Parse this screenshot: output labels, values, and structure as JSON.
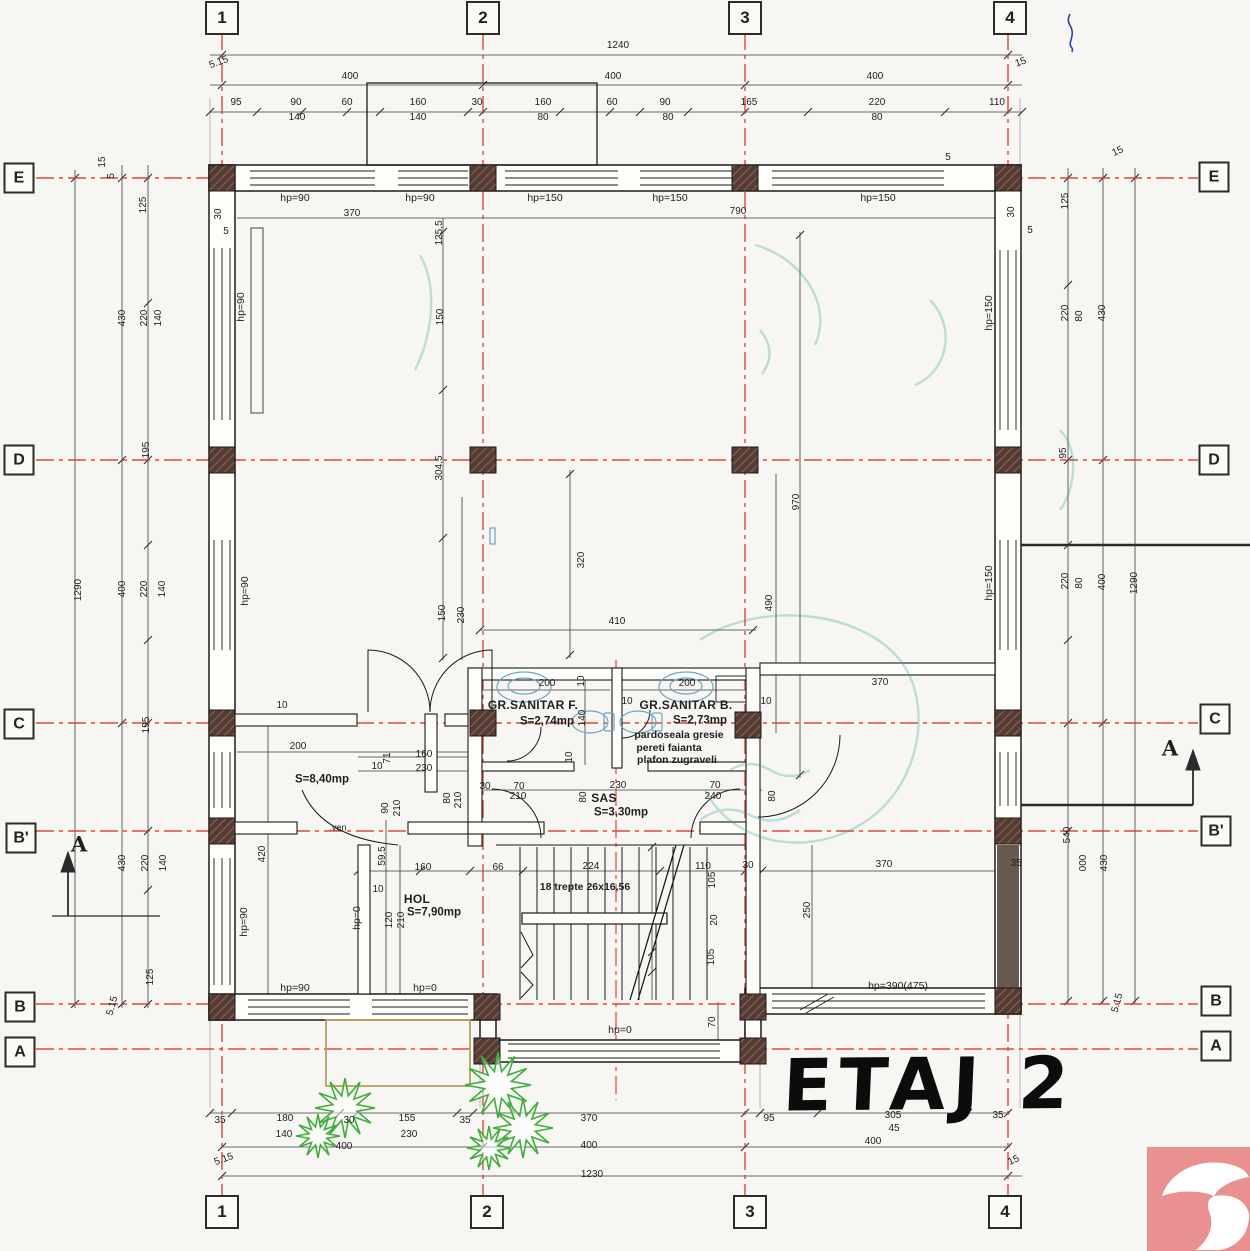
{
  "title": {
    "text": "ETAJ 2"
  },
  "colors": {
    "axis_red": "#d63c2e",
    "wall_ink": "#1b1b1b",
    "column_fill": "#4e3e37",
    "column_hatch": "#a8574a",
    "stamp_teal": "#35a191",
    "plant_green": "#3fae3c",
    "fixture_blue": "#69a7c4",
    "logo_salmon": "#e99090",
    "paper": "#f7f6f2"
  },
  "grid_bubbles": {
    "top": [
      {
        "label": "1",
        "x": 222,
        "y": 18
      },
      {
        "label": "2",
        "x": 483,
        "y": 18
      },
      {
        "label": "3",
        "x": 745,
        "y": 18
      },
      {
        "label": "4",
        "x": 1010,
        "y": 18
      }
    ],
    "bottom": [
      {
        "label": "1",
        "x": 222,
        "y": 1212
      },
      {
        "label": "2",
        "x": 487,
        "y": 1212
      },
      {
        "label": "3",
        "x": 750,
        "y": 1212
      },
      {
        "label": "4",
        "x": 1005,
        "y": 1212
      }
    ],
    "left": [
      {
        "label": "E",
        "x": 19,
        "y": 178
      },
      {
        "label": "D",
        "x": 19,
        "y": 460
      },
      {
        "label": "C",
        "x": 19,
        "y": 724
      },
      {
        "label": "B'",
        "x": 21,
        "y": 838
      },
      {
        "label": "B",
        "x": 20,
        "y": 1007
      },
      {
        "label": "A",
        "x": 20,
        "y": 1052
      }
    ],
    "right": [
      {
        "label": "E",
        "x": 1214,
        "y": 177
      },
      {
        "label": "D",
        "x": 1214,
        "y": 460
      },
      {
        "label": "C",
        "x": 1215,
        "y": 719
      },
      {
        "label": "B'",
        "x": 1216,
        "y": 831
      },
      {
        "label": "B",
        "x": 1216,
        "y": 1001
      },
      {
        "label": "A",
        "x": 1216,
        "y": 1046
      }
    ]
  },
  "rooms": [
    {
      "name": "GR.SANITAR F.",
      "area": "S=2,74mp",
      "nx": 533,
      "ny": 705,
      "ax": 547,
      "ay": 722
    },
    {
      "name": "GR.SANITAR B.",
      "area": "S=2,73mp",
      "nx": 686,
      "ny": 705,
      "ax": 700,
      "ay": 721
    },
    {
      "name": "SAS",
      "area": "S=3,30mp",
      "nx": 604,
      "ny": 798,
      "ax": 621,
      "ay": 813
    },
    {
      "name": "HOL",
      "area": "S=7,90mp",
      "nx": 417,
      "ny": 899,
      "ax": 434,
      "ay": 913
    },
    {
      "name": "",
      "area": "S=8,40mp",
      "nx": 322,
      "ny": 766,
      "ax": 322,
      "ay": 780
    }
  ],
  "finish_notes": [
    {
      "t": "pardoseala gresie",
      "x": 679,
      "y": 735
    },
    {
      "t": "pereti faianta",
      "x": 669,
      "y": 748
    },
    {
      "t": "plafon zugraveli",
      "x": 677,
      "y": 760
    }
  ],
  "stairs_note": {
    "t": "18 trepte 26x16,56",
    "x": 585,
    "y": 887
  },
  "vent_note": {
    "t": ".ven",
    "x": 338,
    "y": 828
  },
  "section_labels": [
    {
      "t": "A",
      "x": 79,
      "y": 844
    },
    {
      "t": "A",
      "x": 1170,
      "y": 748
    }
  ],
  "hp_labels": [
    {
      "t": "hp=90",
      "x": 295,
      "y": 198
    },
    {
      "t": "hp=90",
      "x": 420,
      "y": 198
    },
    {
      "t": "hp=150",
      "x": 545,
      "y": 198
    },
    {
      "t": "hp=150",
      "x": 670,
      "y": 198
    },
    {
      "t": "hp=150",
      "x": 878,
      "y": 198
    },
    {
      "t": "hp=90",
      "x": 241,
      "y": 307,
      "r": -90
    },
    {
      "t": "hp=90",
      "x": 245,
      "y": 591,
      "r": -90
    },
    {
      "t": "hp=90",
      "x": 244,
      "y": 922,
      "r": -90
    },
    {
      "t": "hp=0",
      "x": 357,
      "y": 918,
      "r": -90
    },
    {
      "t": "hp=150",
      "x": 989,
      "y": 313,
      "r": -90
    },
    {
      "t": "hp=150",
      "x": 989,
      "y": 583,
      "r": -90
    },
    {
      "t": "hp=90",
      "x": 295,
      "y": 988
    },
    {
      "t": "hp=0",
      "x": 425,
      "y": 988
    },
    {
      "t": "hp=0",
      "x": 620,
      "y": 1030
    },
    {
      "t": "hp=390(475)",
      "x": 898,
      "y": 986
    }
  ],
  "dim_labels": [
    {
      "t": "1240",
      "x": 618,
      "y": 46
    },
    {
      "t": "5.15",
      "x": 219,
      "y": 63,
      "r": -20
    },
    {
      "t": "400",
      "x": 350,
      "y": 77
    },
    {
      "t": "400",
      "x": 613,
      "y": 77
    },
    {
      "t": "400",
      "x": 875,
      "y": 77
    },
    {
      "t": "15",
      "x": 1021,
      "y": 63,
      "r": -20
    },
    {
      "t": "95",
      "x": 236,
      "y": 103
    },
    {
      "t": "90",
      "x": 296,
      "y": 103
    },
    {
      "t": "60",
      "x": 347,
      "y": 103
    },
    {
      "t": "160",
      "x": 418,
      "y": 103
    },
    {
      "t": "30",
      "x": 477,
      "y": 103
    },
    {
      "t": "160",
      "x": 543,
      "y": 103
    },
    {
      "t": "60",
      "x": 612,
      "y": 103
    },
    {
      "t": "90",
      "x": 665,
      "y": 103
    },
    {
      "t": "165",
      "x": 749,
      "y": 103
    },
    {
      "t": "220",
      "x": 877,
      "y": 103
    },
    {
      "t": "110",
      "x": 997,
      "y": 103
    },
    {
      "t": "140",
      "x": 297,
      "y": 118
    },
    {
      "t": "140",
      "x": 418,
      "y": 118
    },
    {
      "t": "80",
      "x": 543,
      "y": 118
    },
    {
      "t": "80",
      "x": 668,
      "y": 118
    },
    {
      "t": "80",
      "x": 877,
      "y": 118
    },
    {
      "t": "370",
      "x": 352,
      "y": 214
    },
    {
      "t": "790",
      "x": 738,
      "y": 212
    },
    {
      "t": "125.5",
      "x": 440,
      "y": 233,
      "r": -90
    },
    {
      "t": "30",
      "x": 219,
      "y": 214,
      "r": -90
    },
    {
      "t": "5",
      "x": 226,
      "y": 232
    },
    {
      "t": "30",
      "x": 1012,
      "y": 212,
      "r": -90
    },
    {
      "t": "5",
      "x": 1030,
      "y": 231
    },
    {
      "t": "5",
      "x": 948,
      "y": 158
    },
    {
      "t": "15",
      "x": 103,
      "y": 162,
      "r": -90
    },
    {
      "t": "5",
      "x": 112,
      "y": 176,
      "r": -90
    },
    {
      "t": "15",
      "x": 1118,
      "y": 152,
      "r": -25
    },
    {
      "t": "125",
      "x": 144,
      "y": 205,
      "r": -90
    },
    {
      "t": "430",
      "x": 123,
      "y": 318,
      "r": -90
    },
    {
      "t": "220",
      "x": 145,
      "y": 318,
      "r": -90
    },
    {
      "t": "140",
      "x": 159,
      "y": 318,
      "r": -90
    },
    {
      "t": "195",
      "x": 147,
      "y": 450,
      "r": -90
    },
    {
      "t": "1290",
      "x": 79,
      "y": 590,
      "r": -90
    },
    {
      "t": "400",
      "x": 123,
      "y": 589,
      "r": -90
    },
    {
      "t": "220",
      "x": 145,
      "y": 589,
      "r": -90
    },
    {
      "t": "140",
      "x": 163,
      "y": 589,
      "r": -90
    },
    {
      "t": "195",
      "x": 147,
      "y": 725,
      "r": -90
    },
    {
      "t": "430",
      "x": 123,
      "y": 863,
      "r": -90
    },
    {
      "t": "220",
      "x": 146,
      "y": 863,
      "r": -90
    },
    {
      "t": "140",
      "x": 164,
      "y": 863,
      "r": -90
    },
    {
      "t": "125",
      "x": 151,
      "y": 977,
      "r": -90
    },
    {
      "t": "5.15",
      "x": 113,
      "y": 1006,
      "r": -75
    },
    {
      "t": "125",
      "x": 1066,
      "y": 201,
      "r": -90
    },
    {
      "t": "220",
      "x": 1066,
      "y": 313,
      "r": -90
    },
    {
      "t": "80",
      "x": 1080,
      "y": 316,
      "r": -90
    },
    {
      "t": "430",
      "x": 1103,
      "y": 313,
      "r": -90
    },
    {
      "t": "95",
      "x": 1064,
      "y": 453,
      "r": -90
    },
    {
      "t": "220",
      "x": 1066,
      "y": 581,
      "r": -90
    },
    {
      "t": "80",
      "x": 1080,
      "y": 583,
      "r": -90
    },
    {
      "t": "400",
      "x": 1103,
      "y": 582,
      "r": -90
    },
    {
      "t": "1290",
      "x": 1135,
      "y": 583,
      "r": -90
    },
    {
      "t": "540",
      "x": 1068,
      "y": 835,
      "r": -90
    },
    {
      "t": "000",
      "x": 1084,
      "y": 863,
      "r": -90
    },
    {
      "t": "430",
      "x": 1105,
      "y": 863,
      "r": -90
    },
    {
      "t": "35",
      "x": 1016,
      "y": 864
    },
    {
      "t": "5.15",
      "x": 1118,
      "y": 1003,
      "r": -75
    },
    {
      "t": "150",
      "x": 441,
      "y": 317,
      "r": -90
    },
    {
      "t": "304.5",
      "x": 440,
      "y": 468,
      "r": -90
    },
    {
      "t": "150",
      "x": 443,
      "y": 613,
      "r": -90
    },
    {
      "t": "230",
      "x": 462,
      "y": 615,
      "r": -90
    },
    {
      "t": "320",
      "x": 582,
      "y": 560,
      "r": -90
    },
    {
      "t": "410",
      "x": 617,
      "y": 622
    },
    {
      "t": "970",
      "x": 797,
      "y": 502,
      "r": -90
    },
    {
      "t": "490",
      "x": 770,
      "y": 603,
      "r": -90
    },
    {
      "t": "200",
      "x": 547,
      "y": 684
    },
    {
      "t": "10",
      "x": 582,
      "y": 681,
      "r": -90
    },
    {
      "t": "200",
      "x": 687,
      "y": 684
    },
    {
      "t": "10",
      "x": 627,
      "y": 702
    },
    {
      "t": "10",
      "x": 766,
      "y": 702
    },
    {
      "t": "140",
      "x": 583,
      "y": 718,
      "r": -90
    },
    {
      "t": "10",
      "x": 570,
      "y": 757,
      "r": -90
    },
    {
      "t": "370",
      "x": 880,
      "y": 683
    },
    {
      "t": "30",
      "x": 485,
      "y": 787
    },
    {
      "t": "70",
      "x": 519,
      "y": 787
    },
    {
      "t": "210",
      "x": 518,
      "y": 797
    },
    {
      "t": "230",
      "x": 618,
      "y": 786
    },
    {
      "t": "80",
      "x": 584,
      "y": 797,
      "r": -90
    },
    {
      "t": "70",
      "x": 715,
      "y": 786
    },
    {
      "t": "240",
      "x": 713,
      "y": 797
    },
    {
      "t": "80",
      "x": 773,
      "y": 796,
      "r": -90
    },
    {
      "t": "10",
      "x": 282,
      "y": 706
    },
    {
      "t": "200",
      "x": 298,
      "y": 747
    },
    {
      "t": "71",
      "x": 388,
      "y": 758,
      "r": -90
    },
    {
      "t": "10",
      "x": 377,
      "y": 767
    },
    {
      "t": "160",
      "x": 424,
      "y": 755
    },
    {
      "t": "230",
      "x": 424,
      "y": 769
    },
    {
      "t": "90",
      "x": 386,
      "y": 808,
      "r": -90
    },
    {
      "t": "210",
      "x": 398,
      "y": 808,
      "r": -90
    },
    {
      "t": "80",
      "x": 448,
      "y": 798,
      "r": -90
    },
    {
      "t": "210",
      "x": 459,
      "y": 800,
      "r": -90
    },
    {
      "t": "420",
      "x": 263,
      "y": 854,
      "r": -90
    },
    {
      "t": "59.5",
      "x": 383,
      "y": 856,
      "r": -90
    },
    {
      "t": "10",
      "x": 378,
      "y": 890
    },
    {
      "t": "120",
      "x": 390,
      "y": 920,
      "r": -90
    },
    {
      "t": "210",
      "x": 402,
      "y": 920,
      "r": -90
    },
    {
      "t": "160",
      "x": 423,
      "y": 868
    },
    {
      "t": "66",
      "x": 498,
      "y": 868
    },
    {
      "t": "224",
      "x": 591,
      "y": 867
    },
    {
      "t": "110",
      "x": 703,
      "y": 867
    },
    {
      "t": "30",
      "x": 748,
      "y": 866
    },
    {
      "t": "105",
      "x": 713,
      "y": 880,
      "r": -90
    },
    {
      "t": "20",
      "x": 715,
      "y": 920,
      "r": -90
    },
    {
      "t": "105",
      "x": 712,
      "y": 957,
      "r": -90
    },
    {
      "t": "70",
      "x": 713,
      "y": 1022,
      "r": -90
    },
    {
      "t": "250",
      "x": 808,
      "y": 910,
      "r": -90
    },
    {
      "t": "370",
      "x": 884,
      "y": 865
    },
    {
      "t": "35",
      "x": 220,
      "y": 1121
    },
    {
      "t": "180",
      "x": 285,
      "y": 1119
    },
    {
      "t": "30",
      "x": 349,
      "y": 1121
    },
    {
      "t": "155",
      "x": 407,
      "y": 1119
    },
    {
      "t": "35",
      "x": 465,
      "y": 1121
    },
    {
      "t": "370",
      "x": 589,
      "y": 1119
    },
    {
      "t": "95",
      "x": 769,
      "y": 1119
    },
    {
      "t": "305",
      "x": 893,
      "y": 1116
    },
    {
      "t": "35",
      "x": 998,
      "y": 1116
    },
    {
      "t": "140",
      "x": 284,
      "y": 1135
    },
    {
      "t": "230",
      "x": 409,
      "y": 1135
    },
    {
      "t": "45",
      "x": 894,
      "y": 1129
    },
    {
      "t": "400",
      "x": 344,
      "y": 1147
    },
    {
      "t": "400",
      "x": 589,
      "y": 1146
    },
    {
      "t": "400",
      "x": 873,
      "y": 1142
    },
    {
      "t": "5.15",
      "x": 224,
      "y": 1160,
      "r": -20
    },
    {
      "t": "15",
      "x": 1014,
      "y": 1161,
      "r": -25
    },
    {
      "t": "1230",
      "x": 592,
      "y": 1175
    }
  ]
}
